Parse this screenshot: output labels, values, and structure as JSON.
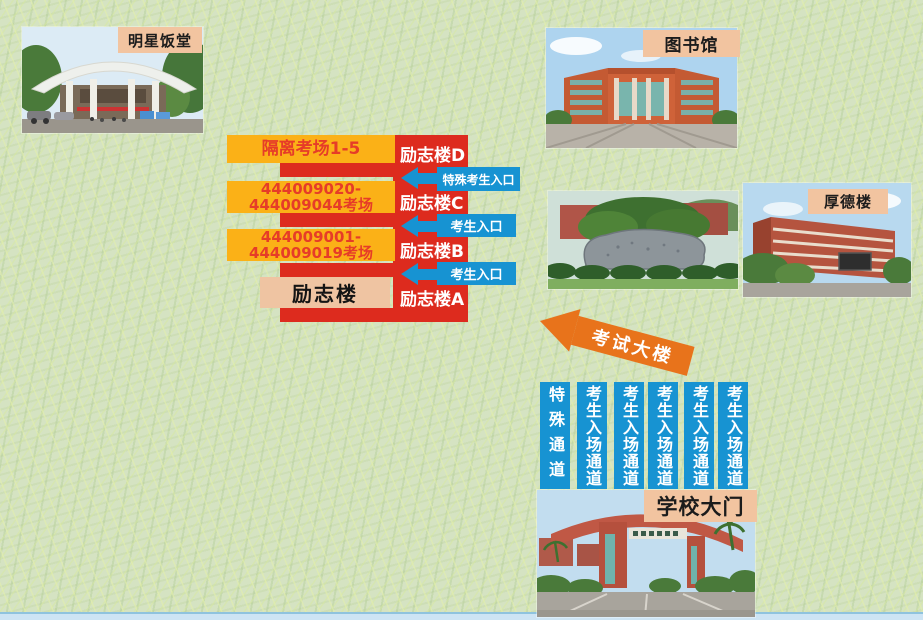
{
  "photo_labels": {
    "canteen": "明星饭堂",
    "library": "图书馆",
    "houde": "厚德楼",
    "gate": "学校大门"
  },
  "diagram": {
    "buildings": [
      {
        "label": "励志楼D"
      },
      {
        "label": "励志楼C"
      },
      {
        "label": "励志楼B"
      },
      {
        "label": "励志楼A"
      }
    ],
    "room_boxes": [
      {
        "line1": "隔离考场1-5",
        "line2": ""
      },
      {
        "line1": "444009020-",
        "line2": "444009044考场"
      },
      {
        "line1": "444009001-",
        "line2": "444009019考场"
      }
    ],
    "building_name": "励志楼",
    "entrances": [
      {
        "label": "特殊考生入口"
      },
      {
        "label": "考生入口"
      },
      {
        "label": "考生入口"
      }
    ],
    "exam_building_arrow": "考试大楼"
  },
  "channels": [
    {
      "label": "特殊通道"
    },
    {
      "label": "考生入场通道"
    },
    {
      "label": "考生入场通道"
    },
    {
      "label": "考生入场通道"
    },
    {
      "label": "考生入场通道"
    },
    {
      "label": "考生入场通道"
    }
  ],
  "colors": {
    "red": "#dd2b1e",
    "yellow": "#fbb117",
    "blue": "#1793d2",
    "orange": "#e8731b",
    "peach": "#f2c4a0",
    "background": "#d5e3c2"
  }
}
